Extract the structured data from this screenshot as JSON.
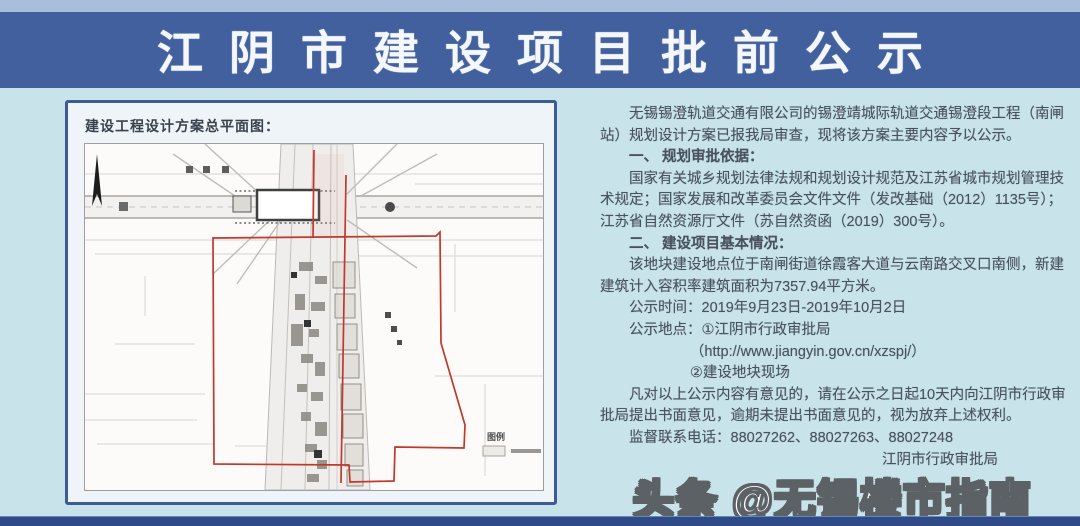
{
  "header": {
    "title": "江阴市建设项目批前公示"
  },
  "map_panel": {
    "title": "建设工程设计方案总平面图：",
    "legend_label": "图例"
  },
  "notice": {
    "intro": "无锡锡澄轨道交通有限公司的锡澄靖城际轨道交通锡澄段工程（南闸站）规划设计方案已报我局审查，现将该方案主要内容予以公示。",
    "section1_heading": "一、 规划审批依据：",
    "section1_body": "国家有关城乡规划法律法规和规划设计规范及江苏省城市规划管理技术规定；国家发展和改革委员会文件文件（发改基础（2012）1135号）；江苏省自然资源厅文件（苏自然资函（2019）300号）。",
    "section2_heading": "二、 建设项目基本情况：",
    "section2_body": "该地块建设地点位于南闸街道徐霞客大道与云南路交叉口南侧，新建建筑计入容积率建筑面积为7357.94平方米。",
    "publicity_time": "公示时间：2019年9月23日-2019年10月2日",
    "publicity_place": "公示地点：①江阴市行政审批局",
    "publicity_url": "（http://www.jiangyin.gov.cn/xzspj/）",
    "publicity_site": "②建设地块现场",
    "feedback": "凡对以上公示内容有意见的，请在公示之日起10天内向江阴市行政审批局提出书面意见，逾期未提出书面意见的，视为放弃上述权利。",
    "phone": "监督联系电话：88027262、88027263、88027248",
    "signature": "江阴市行政审批局"
  },
  "watermark": "头条 @无锡楼市指南",
  "colors": {
    "header_bg": "#42609d",
    "top_strip": "#a9bedb",
    "body_bg": "#c8e3ea",
    "panel_border": "#3d5b94",
    "boundary_red": "#c0392b",
    "bottom_bar": "#2e4b87"
  }
}
